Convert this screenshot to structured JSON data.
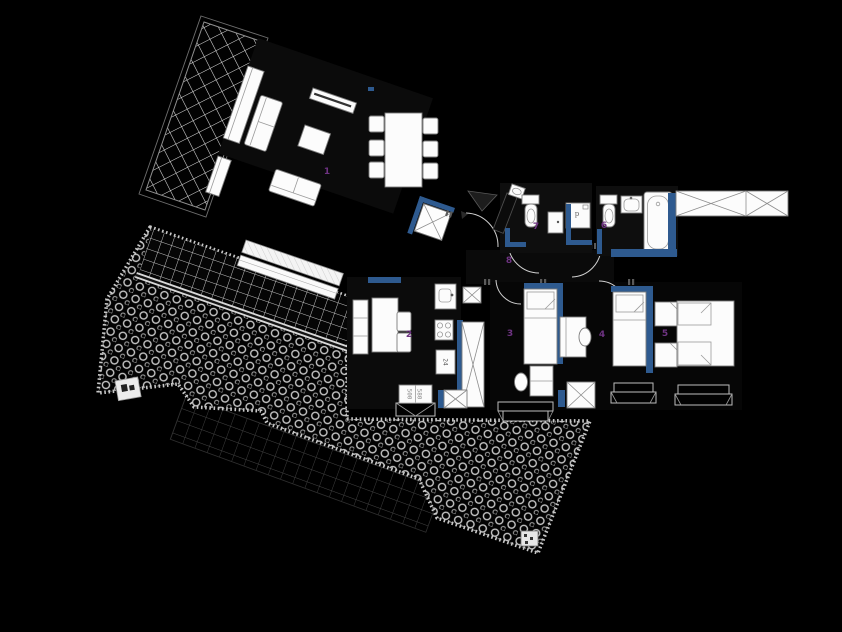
{
  "canvas": {
    "width": 842,
    "height": 632
  },
  "colors": {
    "background": "#000000",
    "wall_accent": "#2e5a8f",
    "room_number": "#6e3382",
    "furniture_fill": "#fcfcfc",
    "furniture_stroke": "#7d7d7d",
    "hatch_line": "#d9d9d9",
    "pebble_line": "#c6c6c6"
  },
  "room_labels": [
    {
      "name": "living-room",
      "number": "1",
      "x": 327,
      "y": 172
    },
    {
      "name": "kitchen",
      "number": "2",
      "x": 409,
      "y": 335
    },
    {
      "name": "bedroom-left",
      "number": "3",
      "x": 510,
      "y": 334
    },
    {
      "name": "bedroom-middle",
      "number": "4",
      "x": 602,
      "y": 335
    },
    {
      "name": "bedroom-master",
      "number": "5",
      "x": 665,
      "y": 334
    },
    {
      "name": "bathroom",
      "number": "6",
      "x": 604,
      "y": 226
    },
    {
      "name": "wc",
      "number": "7",
      "x": 536,
      "y": 227
    },
    {
      "name": "hall",
      "number": "8",
      "x": 509,
      "y": 261
    }
  ],
  "annotations": [
    {
      "name": "kitchen-appliance-label",
      "text": "24",
      "x": 445,
      "y": 362,
      "rotate": 90
    },
    {
      "name": "washer-label",
      "text": "p",
      "x": 577,
      "y": 214,
      "rotate": 0
    },
    {
      "name": "window-dim-a",
      "text": "500",
      "x": 409,
      "y": 394,
      "rotate": 90
    },
    {
      "name": "window-dim-b",
      "text": "580",
      "x": 419,
      "y": 394,
      "rotate": 90
    }
  ]
}
